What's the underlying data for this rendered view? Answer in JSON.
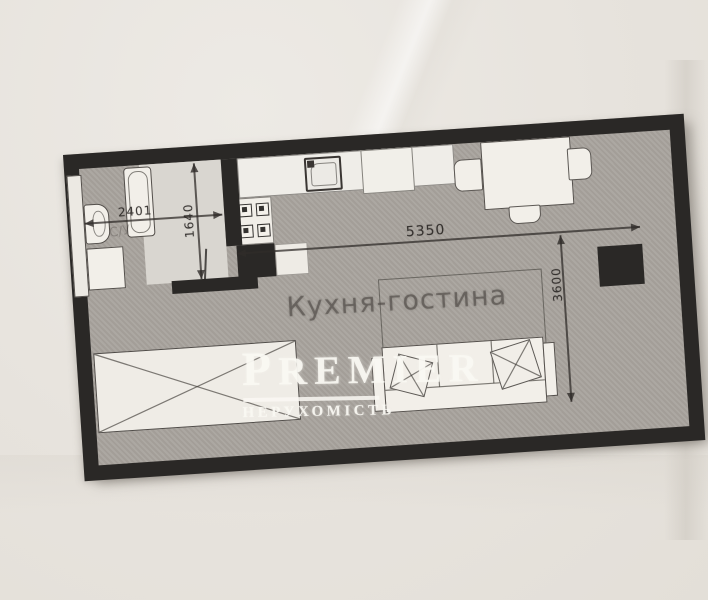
{
  "watermark": {
    "brand": "PREMIER",
    "tagline": "НЕРУХОМІСТЬ"
  },
  "plan": {
    "room_label": "Кухня-гостина",
    "bathroom_label": "С/У",
    "dimensions": {
      "bathroom_width": "2401",
      "bathroom_depth": "1640",
      "living_width": "5350",
      "living_depth": "3600"
    },
    "fixtures": [
      "shower-strip",
      "bathtub",
      "toilet",
      "washing-machine",
      "kitchen-counter",
      "sink",
      "stove",
      "cabinet",
      "dining-table",
      "chairs",
      "sofa",
      "pillows",
      "wardrobe",
      "column"
    ]
  },
  "colors": {
    "paper": "#e8e4df",
    "wall": "#2a2826",
    "floor": "#a8a39d",
    "fixture_fill": "#f2efe9",
    "dimension_ink": "#302c29",
    "watermark": "#faf8f3"
  }
}
